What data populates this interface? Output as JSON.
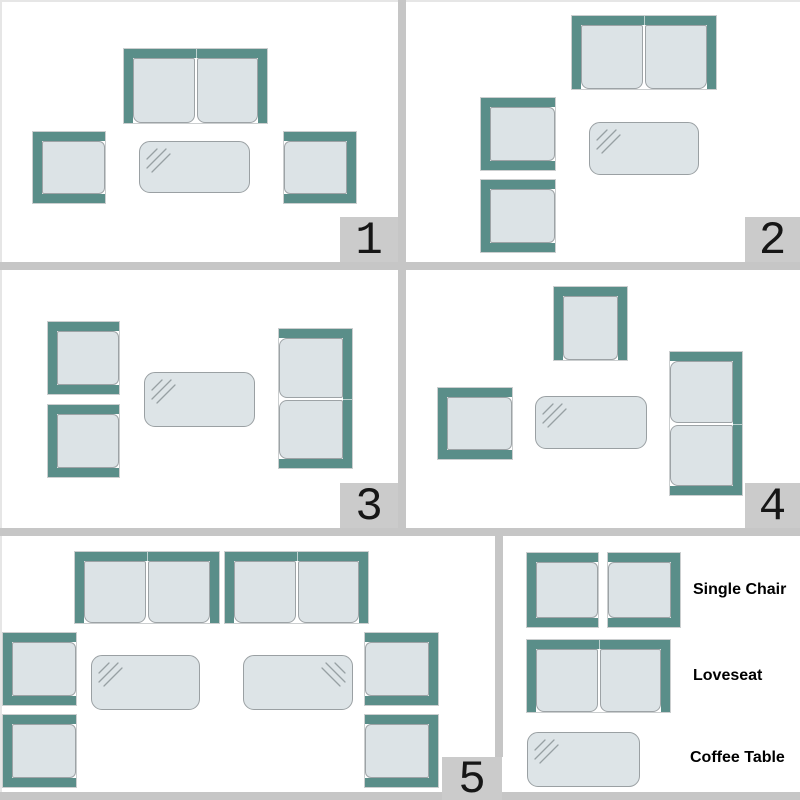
{
  "colors": {
    "frame": "#5a8e89",
    "cushion": "#dce3e6",
    "cushion_border": "#9da3a6",
    "table_fill": "#dde4e7",
    "divider": "#c6c6c6",
    "badge_bg": "#cbcbcb",
    "text": "#000000"
  },
  "panels": [
    {
      "id": 1,
      "label": "1",
      "items": [
        {
          "type": "loveseat",
          "facing": "down",
          "x": 124,
          "y": 49,
          "w": 143,
          "h": 74
        },
        {
          "type": "single-chair",
          "facing": "right",
          "x": 33,
          "y": 132,
          "w": 72,
          "h": 71
        },
        {
          "type": "coffee-table",
          "shine": "tl",
          "x": 139,
          "y": 141,
          "w": 111,
          "h": 52
        },
        {
          "type": "single-chair",
          "facing": "left",
          "x": 284,
          "y": 132,
          "w": 72,
          "h": 71
        }
      ]
    },
    {
      "id": 2,
      "label": "2",
      "items": [
        {
          "type": "loveseat",
          "facing": "down",
          "x": 572,
          "y": 16,
          "w": 144,
          "h": 73
        },
        {
          "type": "single-chair",
          "facing": "right",
          "x": 481,
          "y": 98,
          "w": 74,
          "h": 72
        },
        {
          "type": "single-chair",
          "facing": "right",
          "x": 481,
          "y": 180,
          "w": 74,
          "h": 72
        },
        {
          "type": "coffee-table",
          "shine": "tl",
          "x": 589,
          "y": 122,
          "w": 110,
          "h": 53
        }
      ]
    },
    {
      "id": 3,
      "label": "3",
      "items": [
        {
          "type": "single-chair",
          "facing": "right",
          "x": 48,
          "y": 322,
          "w": 71,
          "h": 72
        },
        {
          "type": "single-chair",
          "facing": "right",
          "x": 48,
          "y": 405,
          "w": 71,
          "h": 72
        },
        {
          "type": "coffee-table",
          "shine": "tl",
          "x": 144,
          "y": 372,
          "w": 111,
          "h": 55
        },
        {
          "type": "loveseat",
          "facing": "left",
          "x": 279,
          "y": 329,
          "w": 73,
          "h": 139
        }
      ]
    },
    {
      "id": 4,
      "label": "4",
      "items": [
        {
          "type": "single-chair",
          "facing": "down",
          "x": 554,
          "y": 287,
          "w": 73,
          "h": 73
        },
        {
          "type": "single-chair",
          "facing": "right",
          "x": 438,
          "y": 388,
          "w": 74,
          "h": 71
        },
        {
          "type": "coffee-table",
          "shine": "tl",
          "x": 535,
          "y": 396,
          "w": 112,
          "h": 53
        },
        {
          "type": "loveseat",
          "facing": "left",
          "x": 670,
          "y": 352,
          "w": 72,
          "h": 143
        }
      ]
    },
    {
      "id": 5,
      "label": "5",
      "items": [
        {
          "type": "loveseat",
          "facing": "down",
          "x": 75,
          "y": 552,
          "w": 144,
          "h": 71
        },
        {
          "type": "loveseat",
          "facing": "down",
          "x": 225,
          "y": 552,
          "w": 143,
          "h": 71
        },
        {
          "type": "single-chair",
          "facing": "right",
          "x": 3,
          "y": 633,
          "w": 73,
          "h": 72
        },
        {
          "type": "single-chair",
          "facing": "right",
          "x": 3,
          "y": 715,
          "w": 73,
          "h": 72
        },
        {
          "type": "coffee-table",
          "shine": "tl",
          "x": 91,
          "y": 655,
          "w": 109,
          "h": 55
        },
        {
          "type": "coffee-table",
          "shine": "tr",
          "x": 243,
          "y": 655,
          "w": 110,
          "h": 55
        },
        {
          "type": "single-chair",
          "facing": "left",
          "x": 365,
          "y": 633,
          "w": 73,
          "h": 72
        },
        {
          "type": "single-chair",
          "facing": "left",
          "x": 365,
          "y": 715,
          "w": 73,
          "h": 72
        }
      ]
    }
  ],
  "legend": {
    "items": [
      {
        "label": "Single Chair",
        "glyphs": [
          {
            "type": "single-chair",
            "facing": "right",
            "x": 527,
            "y": 553,
            "w": 71,
            "h": 74
          },
          {
            "type": "single-chair",
            "facing": "left",
            "x": 608,
            "y": 553,
            "w": 72,
            "h": 74
          }
        ]
      },
      {
        "label": "Loveseat",
        "glyphs": [
          {
            "type": "loveseat",
            "facing": "down",
            "x": 527,
            "y": 640,
            "w": 143,
            "h": 72
          }
        ]
      },
      {
        "label": "Coffee Table",
        "glyphs": [
          {
            "type": "coffee-table",
            "shine": "tl",
            "x": 527,
            "y": 732,
            "w": 113,
            "h": 55
          }
        ]
      }
    ]
  }
}
